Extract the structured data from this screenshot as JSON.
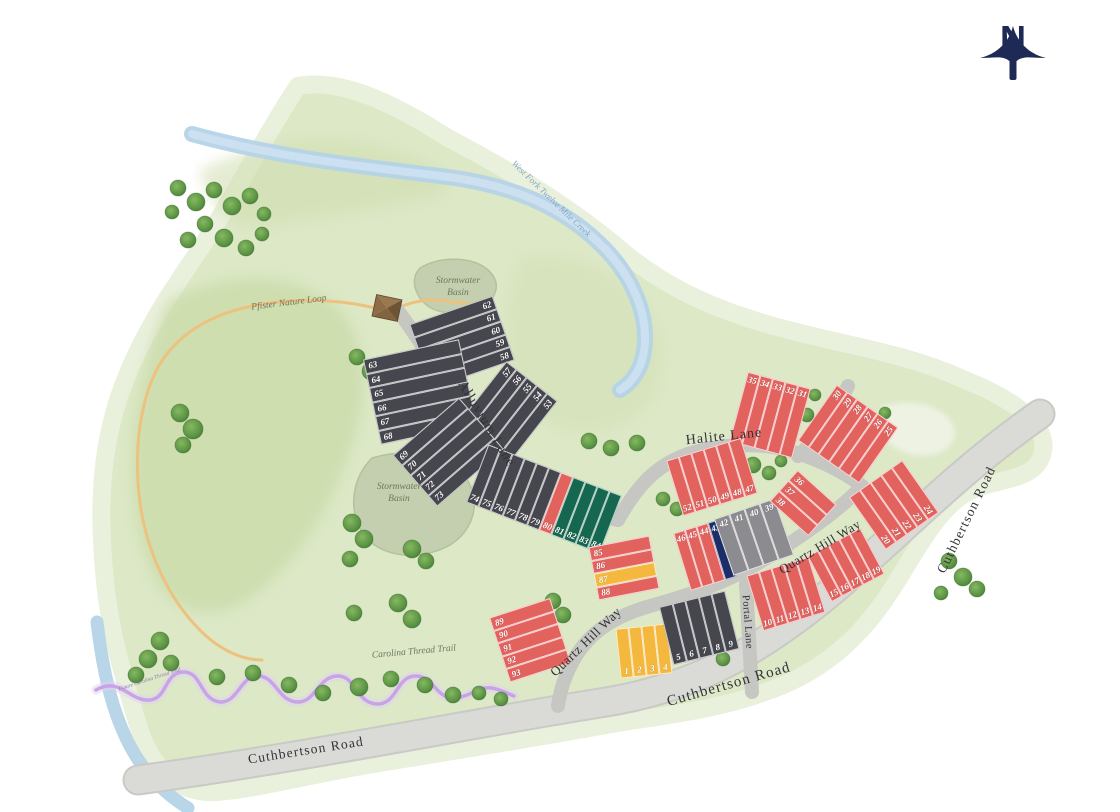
{
  "north_arrow": {
    "label": "N",
    "color": "#1e2a56"
  },
  "colors": {
    "dark": "#46464e",
    "red": "#e2625e",
    "green": "#15684f",
    "yellow": "#f3b83d",
    "navy": "#1c2e6a",
    "gray": "#8c8c90",
    "terrain": "#dce8c6",
    "terrain_dark": "#cbdcaa",
    "road": "#dadad6",
    "creek": "#b5d3e7",
    "trail_pfister": "#edc27e",
    "trail_carolina": "#c9a3e8",
    "basin": "#c3cfae"
  },
  "labels": [
    {
      "name": "street-label-alluvium-lane",
      "text": "Alluvium Lane",
      "x": 486,
      "y": 424,
      "rot": 59,
      "size": 14,
      "cls": "street",
      "ls": 1
    },
    {
      "name": "street-label-halite-lane",
      "text": "Halite Lane",
      "x": 724,
      "y": 437,
      "rot": -6,
      "size": 14,
      "cls": "street",
      "ls": 1
    },
    {
      "name": "street-label-quartz-hill-way-upper",
      "text": "Quartz Hill Way",
      "x": 820,
      "y": 547,
      "rot": -31,
      "size": 13,
      "cls": "street",
      "ls": 0.5
    },
    {
      "name": "street-label-quartz-hill-way-lower",
      "text": "Quartz Hill Way",
      "x": 586,
      "y": 642,
      "rot": -44,
      "size": 13,
      "cls": "street",
      "ls": 0.5
    },
    {
      "name": "street-label-portal-lane",
      "text": "Portal Lane",
      "x": 747,
      "y": 622,
      "rot": 86,
      "size": 10.5,
      "cls": "street",
      "ls": 0.5
    },
    {
      "name": "street-label-cuthbertson-road-west",
      "text": "Cuthbertson Road",
      "x": 306,
      "y": 751,
      "rot": -9,
      "size": 13.5,
      "cls": "street",
      "ls": 1.2
    },
    {
      "name": "street-label-cuthbertson-road-south",
      "text": "Cuthbertson Road",
      "x": 729,
      "y": 685,
      "rot": -16,
      "size": 15,
      "cls": "street",
      "ls": 1.2
    },
    {
      "name": "street-label-cuthbertson-road-east",
      "text": "Cuthbertson Road",
      "x": 967,
      "y": 520,
      "rot": -64,
      "size": 13.5,
      "cls": "street",
      "ls": 1.2
    },
    {
      "name": "label-stormwater-basin-north",
      "text": "Stormwater\nBasin",
      "x": 458,
      "y": 288,
      "rot": 0,
      "size": 9.5,
      "cls": "place"
    },
    {
      "name": "label-stormwater-basin-west",
      "text": "Stormwater\nBasin",
      "x": 399,
      "y": 494,
      "rot": 0,
      "size": 9.5,
      "cls": "place"
    },
    {
      "name": "label-creek-west-fork",
      "text": "West Fork Twelve Mile Creek",
      "x": 551,
      "y": 199,
      "rot": 44,
      "size": 9,
      "cls": "creek"
    },
    {
      "name": "label-pfister-nature-loop",
      "text": "Pfister Nature Loop",
      "x": 289,
      "y": 304,
      "rot": -7,
      "size": 9.5,
      "cls": "place"
    },
    {
      "name": "label-carolina-thread-trail",
      "text": "Carolina Thread Trail",
      "x": 414,
      "y": 653,
      "rot": -5,
      "size": 9.5,
      "cls": "place"
    },
    {
      "name": "label-future-carolina-thread-trail",
      "text": "Future Carolina Thread Trail",
      "x": 150,
      "y": 680,
      "rot": -18,
      "size": 5.5,
      "cls": "tiny"
    }
  ],
  "lot_blocks": [
    {
      "name": "block-58-62",
      "cx": 462,
      "cy": 342,
      "rot": -19,
      "orient": "h",
      "len": 88,
      "cell": 13.5,
      "num": "right",
      "lots": [
        [
          "62",
          "dark"
        ],
        [
          "61",
          "dark"
        ],
        [
          "60",
          "dark"
        ],
        [
          "59",
          "dark"
        ],
        [
          "58",
          "dark"
        ]
      ]
    },
    {
      "name": "block-63-68",
      "cx": 420,
      "cy": 392,
      "rot": -12,
      "orient": "h",
      "len": 98,
      "cell": 14.5,
      "num": "left",
      "lots": [
        [
          "63",
          "dark"
        ],
        [
          "64",
          "dark"
        ],
        [
          "65",
          "dark"
        ],
        [
          "66",
          "dark"
        ],
        [
          "67",
          "dark"
        ],
        [
          "68",
          "dark"
        ]
      ]
    },
    {
      "name": "block-53-57",
      "cx": 508,
      "cy": 412,
      "rot": -52,
      "orient": "h",
      "len": 78,
      "cell": 13,
      "num": "right",
      "lots": [
        [
          "57",
          "dark"
        ],
        [
          "56",
          "dark"
        ],
        [
          "55",
          "dark"
        ],
        [
          "54",
          "dark"
        ],
        [
          "53",
          "dark"
        ]
      ]
    },
    {
      "name": "block-69-73",
      "cx": 448,
      "cy": 452,
      "rot": -41,
      "orient": "h",
      "len": 88,
      "cell": 13.5,
      "num": "left",
      "lots": [
        [
          "69",
          "dark"
        ],
        [
          "70",
          "dark"
        ],
        [
          "71",
          "dark"
        ],
        [
          "72",
          "dark"
        ],
        [
          "73",
          "dark"
        ]
      ]
    },
    {
      "name": "block-74-84",
      "cx": 544,
      "cy": 499,
      "rot": 21,
      "orient": "v",
      "h": 62,
      "cell": 13,
      "num": "bottom",
      "lots": [
        [
          "74",
          "dark"
        ],
        [
          "75",
          "dark"
        ],
        [
          "76",
          "dark"
        ],
        [
          "77",
          "dark"
        ],
        [
          "78",
          "dark"
        ],
        [
          "79",
          "dark"
        ],
        [
          "80",
          "red"
        ],
        [
          "81",
          "green"
        ],
        [
          "82",
          "green"
        ],
        [
          "83",
          "green"
        ],
        [
          "84",
          "green"
        ]
      ]
    },
    {
      "name": "block-85-88",
      "cx": 624,
      "cy": 568,
      "rot": -11,
      "orient": "h",
      "len": 62,
      "cell": 13.5,
      "num": "left",
      "lots": [
        [
          "85",
          "red"
        ],
        [
          "86",
          "red"
        ],
        [
          "87",
          "yellow"
        ],
        [
          "88",
          "red"
        ]
      ]
    },
    {
      "name": "block-89-93",
      "cx": 530,
      "cy": 640,
      "rot": -18,
      "orient": "h",
      "len": 64,
      "cell": 13.5,
      "num": "left",
      "lots": [
        [
          "89",
          "red"
        ],
        [
          "90",
          "red"
        ],
        [
          "91",
          "red"
        ],
        [
          "92",
          "red"
        ],
        [
          "93",
          "red"
        ]
      ]
    },
    {
      "name": "block-1-4",
      "cx": 644,
      "cy": 651,
      "rot": -6,
      "orient": "v",
      "h": 50,
      "cell": 13,
      "num": "bottom",
      "lots": [
        [
          "1",
          "yellow"
        ],
        [
          "2",
          "yellow"
        ],
        [
          "3",
          "yellow"
        ],
        [
          "4",
          "yellow"
        ]
      ]
    },
    {
      "name": "block-5-9",
      "cx": 699,
      "cy": 628,
      "rot": -14,
      "orient": "v",
      "h": 60,
      "cell": 13.5,
      "num": "bottom",
      "lots": [
        [
          "5",
          "dark"
        ],
        [
          "6",
          "dark"
        ],
        [
          "7",
          "dark"
        ],
        [
          "8",
          "dark"
        ],
        [
          "9",
          "dark"
        ]
      ]
    },
    {
      "name": "block-10-14",
      "cx": 786,
      "cy": 594,
      "rot": -17,
      "orient": "v",
      "h": 58,
      "cell": 13,
      "num": "bottom",
      "lots": [
        [
          "10",
          "red"
        ],
        [
          "11",
          "red"
        ],
        [
          "12",
          "red"
        ],
        [
          "13",
          "red"
        ],
        [
          "14",
          "red"
        ]
      ]
    },
    {
      "name": "block-15-19",
      "cx": 846,
      "cy": 565,
      "rot": -28,
      "orient": "v",
      "h": 52,
      "cell": 12,
      "num": "bottom",
      "lots": [
        [
          "15",
          "red"
        ],
        [
          "16",
          "red"
        ],
        [
          "17",
          "red"
        ],
        [
          "18",
          "red"
        ],
        [
          "19",
          "red"
        ]
      ]
    },
    {
      "name": "block-20-24",
      "cx": 894,
      "cy": 505,
      "rot": 55,
      "orient": "h",
      "len": 64,
      "cell": 13,
      "num": "right",
      "lots": [
        [
          "24",
          "red"
        ],
        [
          "23",
          "red"
        ],
        [
          "22",
          "red"
        ],
        [
          "21",
          "red"
        ],
        [
          "20",
          "red"
        ]
      ]
    },
    {
      "name": "block-25-30",
      "cx": 848,
      "cy": 434,
      "rot": -55,
      "orient": "h",
      "len": 68,
      "cell": 12.5,
      "num": "right",
      "lots": [
        [
          "30",
          "red"
        ],
        [
          "29",
          "red"
        ],
        [
          "28",
          "red"
        ],
        [
          "27",
          "red"
        ],
        [
          "26",
          "red"
        ],
        [
          "25",
          "red"
        ]
      ]
    },
    {
      "name": "block-31-35",
      "cx": 770,
      "cy": 415,
      "rot": 15,
      "orient": "v",
      "h": 72,
      "cell": 13,
      "num": "top",
      "lots": [
        [
          "35",
          "red"
        ],
        [
          "34",
          "red"
        ],
        [
          "33",
          "red"
        ],
        [
          "32",
          "red"
        ],
        [
          "31",
          "red"
        ]
      ]
    },
    {
      "name": "block-47-52",
      "cx": 712,
      "cy": 477,
      "rot": -17,
      "orient": "v",
      "h": 58,
      "cell": 13,
      "num": "bottom",
      "lots": [
        [
          "52",
          "red"
        ],
        [
          "51",
          "red"
        ],
        [
          "50",
          "red"
        ],
        [
          "49",
          "red"
        ],
        [
          "48",
          "red"
        ],
        [
          "47",
          "red"
        ]
      ]
    },
    {
      "name": "block-43-46",
      "cx": 705,
      "cy": 555,
      "rot": -17,
      "orient": "v",
      "h": 60,
      "cell": 12,
      "num": "top",
      "lots": [
        [
          "46",
          "red"
        ],
        [
          "45",
          "red"
        ],
        [
          "44",
          "red"
        ],
        [
          "43",
          "navy"
        ]
      ]
    },
    {
      "name": "block-39-42",
      "cx": 754,
      "cy": 537,
      "rot": -19,
      "orient": "v",
      "h": 60,
      "cell": 16,
      "num": "top",
      "lots": [
        [
          "42",
          "gray"
        ],
        [
          "41",
          "gray"
        ],
        [
          "40",
          "gray"
        ],
        [
          "39",
          "gray"
        ]
      ]
    },
    {
      "name": "block-36-38",
      "cx": 803,
      "cy": 503,
      "rot": 42,
      "orient": "h",
      "len": 52,
      "cell": 14,
      "num": "left",
      "lots": [
        [
          "36",
          "red"
        ],
        [
          "37",
          "red"
        ],
        [
          "38",
          "red"
        ]
      ]
    }
  ],
  "trees": [
    [
      178,
      188,
      8
    ],
    [
      196,
      202,
      9
    ],
    [
      214,
      190,
      8
    ],
    [
      232,
      206,
      9
    ],
    [
      250,
      196,
      8
    ],
    [
      264,
      214,
      7
    ],
    [
      205,
      224,
      8
    ],
    [
      188,
      240,
      8
    ],
    [
      224,
      238,
      9
    ],
    [
      246,
      248,
      8
    ],
    [
      262,
      234,
      7
    ],
    [
      172,
      212,
      7
    ],
    [
      180,
      413,
      9
    ],
    [
      193,
      429,
      10
    ],
    [
      183,
      445,
      8
    ],
    [
      357,
      357,
      8
    ],
    [
      371,
      371,
      9
    ],
    [
      352,
      523,
      9
    ],
    [
      364,
      539,
      9
    ],
    [
      350,
      559,
      8
    ],
    [
      412,
      549,
      9
    ],
    [
      426,
      561,
      8
    ],
    [
      398,
      603,
      9
    ],
    [
      412,
      619,
      9
    ],
    [
      354,
      613,
      8
    ],
    [
      589,
      441,
      8
    ],
    [
      611,
      448,
      8
    ],
    [
      637,
      443,
      8
    ],
    [
      663,
      499,
      7
    ],
    [
      677,
      509,
      7
    ],
    [
      719,
      557,
      6
    ],
    [
      737,
      563,
      6
    ],
    [
      753,
      465,
      8
    ],
    [
      769,
      473,
      7
    ],
    [
      807,
      415,
      7
    ],
    [
      815,
      395,
      6
    ],
    [
      781,
      461,
      6
    ],
    [
      553,
      601,
      8
    ],
    [
      563,
      615,
      8
    ],
    [
      723,
      659,
      7
    ],
    [
      885,
      413,
      6
    ],
    [
      160,
      641,
      9
    ],
    [
      148,
      659,
      9
    ],
    [
      136,
      675,
      8
    ],
    [
      171,
      663,
      8
    ],
    [
      217,
      677,
      8
    ],
    [
      253,
      673,
      8
    ],
    [
      289,
      685,
      8
    ],
    [
      323,
      693,
      8
    ],
    [
      359,
      687,
      9
    ],
    [
      391,
      679,
      8
    ],
    [
      425,
      685,
      8
    ],
    [
      453,
      695,
      8
    ],
    [
      479,
      693,
      7
    ],
    [
      501,
      699,
      7
    ],
    [
      949,
      561,
      8
    ],
    [
      963,
      577,
      9
    ],
    [
      977,
      589,
      8
    ],
    [
      941,
      593,
      7
    ]
  ]
}
